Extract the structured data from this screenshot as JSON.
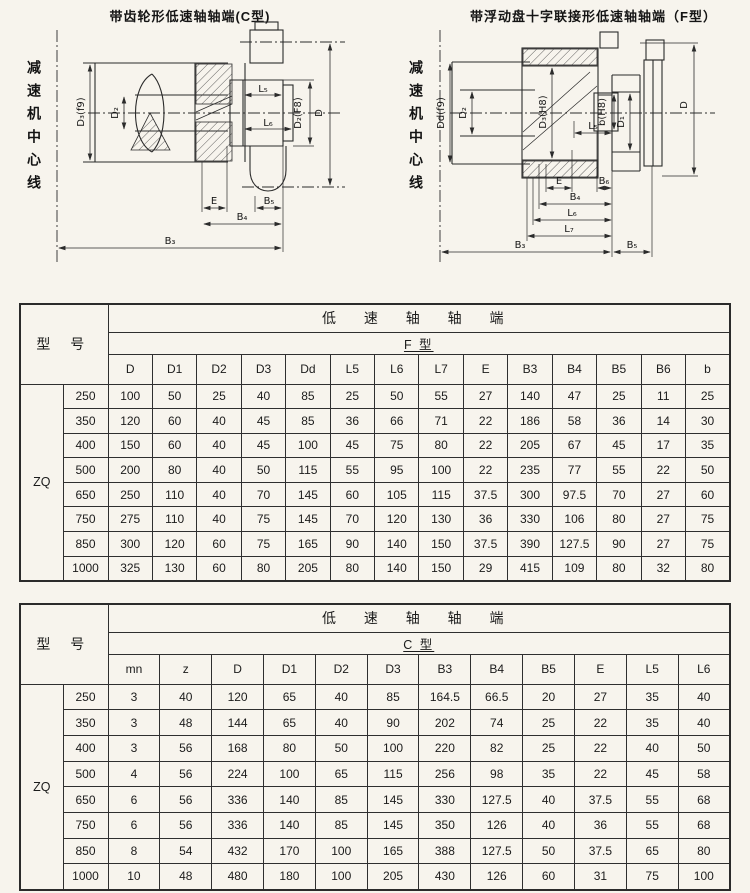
{
  "figures": {
    "left": {
      "title": "带齿轮形低速轴轴端(C型)",
      "centerline": "减速机中心线",
      "labels": {
        "d3": "D₃(f9)",
        "d2": "D₂",
        "l5": "L₅",
        "l6": "L₆",
        "d2f8": "D₂(F8)",
        "d": "D",
        "e": "E",
        "b5": "B₅",
        "b4": "B₄",
        "b3": "B₃"
      }
    },
    "right": {
      "title": "带浮动盘十字联接形低速轴轴端（F型）",
      "centerline": "减速机中心线",
      "labels": {
        "dd": "Dd(f9)",
        "d2": "D₂",
        "d3h8": "D₃(H8)",
        "l5": "L₅",
        "bh8": "b(H8)",
        "d1": "D₁",
        "d": "D",
        "e": "E",
        "b6": "B₆",
        "b4": "B₄",
        "l6": "L₆",
        "l7": "L₇",
        "b3": "B₃",
        "b5": "B₅"
      }
    }
  },
  "table_f": {
    "group_header": "低 速 轴 轴 端",
    "type_header": "F 型",
    "model_header": "型 号",
    "series": "ZQ",
    "columns": [
      "D",
      "D1",
      "D2",
      "D3",
      "Dd",
      "L5",
      "L6",
      "L7",
      "E",
      "B3",
      "B4",
      "B5",
      "B6",
      "b"
    ],
    "rows": [
      [
        "250",
        "100",
        "50",
        "25",
        "40",
        "85",
        "25",
        "50",
        "55",
        "27",
        "140",
        "47",
        "25",
        "11",
        "25"
      ],
      [
        "350",
        "120",
        "60",
        "40",
        "45",
        "85",
        "36",
        "66",
        "71",
        "22",
        "186",
        "58",
        "36",
        "14",
        "30"
      ],
      [
        "400",
        "150",
        "60",
        "40",
        "45",
        "100",
        "45",
        "75",
        "80",
        "22",
        "205",
        "67",
        "45",
        "17",
        "35"
      ],
      [
        "500",
        "200",
        "80",
        "40",
        "50",
        "115",
        "55",
        "95",
        "100",
        "22",
        "235",
        "77",
        "55",
        "22",
        "50"
      ],
      [
        "650",
        "250",
        "110",
        "40",
        "70",
        "145",
        "60",
        "105",
        "115",
        "37.5",
        "300",
        "97.5",
        "70",
        "27",
        "60"
      ],
      [
        "750",
        "275",
        "110",
        "40",
        "75",
        "145",
        "70",
        "120",
        "130",
        "36",
        "330",
        "106",
        "80",
        "27",
        "75"
      ],
      [
        "850",
        "300",
        "120",
        "60",
        "75",
        "165",
        "90",
        "140",
        "150",
        "37.5",
        "390",
        "127.5",
        "90",
        "27",
        "75"
      ],
      [
        "1000",
        "325",
        "130",
        "60",
        "80",
        "205",
        "80",
        "140",
        "150",
        "29",
        "415",
        "109",
        "80",
        "32",
        "80"
      ]
    ]
  },
  "table_c": {
    "group_header": "低 速 轴 轴 端",
    "type_header": "C 型",
    "model_header": "型 号",
    "series": "ZQ",
    "columns": [
      "mn",
      "z",
      "D",
      "D1",
      "D2",
      "D3",
      "B3",
      "B4",
      "B5",
      "E",
      "L5",
      "L6"
    ],
    "rows": [
      [
        "250",
        "3",
        "40",
        "120",
        "65",
        "40",
        "85",
        "164.5",
        "66.5",
        "20",
        "27",
        "35",
        "40"
      ],
      [
        "350",
        "3",
        "48",
        "144",
        "65",
        "40",
        "90",
        "202",
        "74",
        "25",
        "22",
        "35",
        "40"
      ],
      [
        "400",
        "3",
        "56",
        "168",
        "80",
        "50",
        "100",
        "220",
        "82",
        "25",
        "22",
        "40",
        "50"
      ],
      [
        "500",
        "4",
        "56",
        "224",
        "100",
        "65",
        "115",
        "256",
        "98",
        "35",
        "22",
        "45",
        "58"
      ],
      [
        "650",
        "6",
        "56",
        "336",
        "140",
        "85",
        "145",
        "330",
        "127.5",
        "40",
        "37.5",
        "55",
        "68"
      ],
      [
        "750",
        "6",
        "56",
        "336",
        "140",
        "85",
        "145",
        "350",
        "126",
        "40",
        "36",
        "55",
        "68"
      ],
      [
        "850",
        "8",
        "54",
        "432",
        "170",
        "100",
        "165",
        "388",
        "127.5",
        "50",
        "37.5",
        "65",
        "80"
      ],
      [
        "1000",
        "10",
        "48",
        "480",
        "180",
        "100",
        "205",
        "430",
        "126",
        "60",
        "31",
        "75",
        "100"
      ]
    ]
  }
}
